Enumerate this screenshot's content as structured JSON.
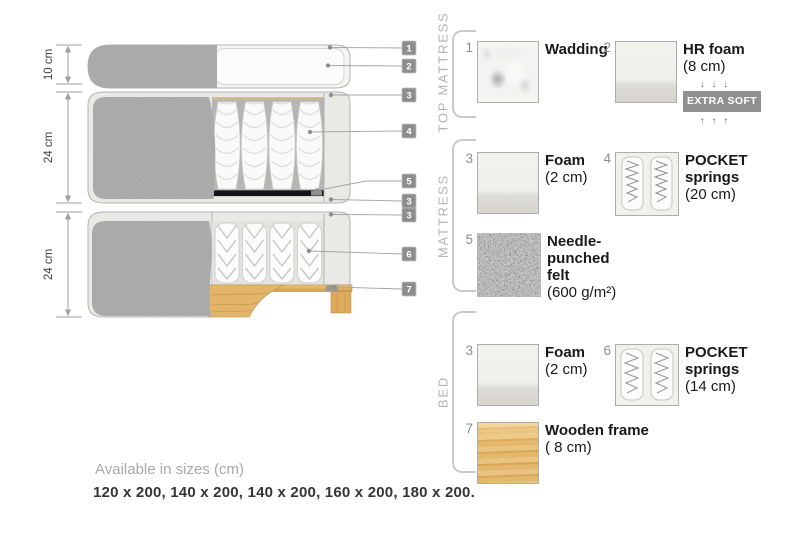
{
  "diagram": {
    "dimension_labels": [
      "10 cm",
      "24 cm",
      "24 cm"
    ],
    "callouts": [
      "1",
      "2",
      "3",
      "4",
      "5",
      "3",
      "3",
      "6",
      "7"
    ]
  },
  "legend": {
    "sections": [
      {
        "title": "TOP MATTRESS",
        "items": [
          {
            "num": "1",
            "name": "Wadding",
            "detail": "",
            "thumb": "wadding-photo"
          },
          {
            "num": "2",
            "name": "HR foam",
            "detail": "(8 cm)",
            "thumb": "foam-photo",
            "arrows_down": "↓ ↓ ↓",
            "badge": "EXTRA SOFT",
            "arrows_up": "↑ ↑ ↑"
          }
        ]
      },
      {
        "title": "MATTRESS",
        "items": [
          {
            "num": "3",
            "name": "Foam",
            "detail": "(2 cm)",
            "thumb": "foam-photo"
          },
          {
            "num": "4",
            "name": "POCKET springs",
            "detail": "(20 cm)",
            "thumb": "pocket-springs-photo"
          },
          {
            "num": "5",
            "name": "Needle-punched felt",
            "detail": "(600 g/m²)",
            "thumb": "felt-photo"
          }
        ]
      },
      {
        "title": "BED",
        "items": [
          {
            "num": "3",
            "name": "Foam",
            "detail": "(2 cm)",
            "thumb": "foam-photo"
          },
          {
            "num": "6",
            "name": "POCKET springs",
            "detail": "(14 cm)",
            "thumb": "pocket-springs-photo"
          },
          {
            "num": "7",
            "name": "Wooden frame",
            "detail": "( 8 cm)",
            "thumb": "wood-photo"
          }
        ]
      }
    ]
  },
  "footer": {
    "availability": "Available in sizes (cm)",
    "sizes": "120 x 200, 140 x 200, 140 x 200, 160 x 200, 180 x 200."
  },
  "colors": {
    "fabric_gray": "#aeaeae",
    "interior_light": "#e9e9e6",
    "springs_bg_dark": "#b5b5b5",
    "felt_black": "#141414",
    "wood_tan": "#dfaf63",
    "callout_gray": "#8d8d8d",
    "badge_gray": "#909090"
  }
}
